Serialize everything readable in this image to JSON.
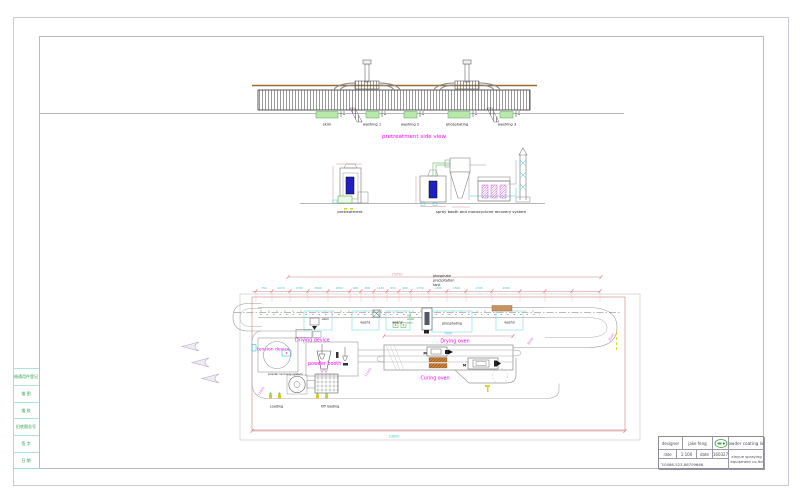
{
  "drawing": {
    "side_view": {
      "title": "pretreatment side view",
      "tank_labels": [
        "skim",
        "washing 1",
        "washing 2",
        "phosphating",
        "washing 3"
      ]
    },
    "elevations": {
      "pretreatment_label": "pretreatment",
      "spray_booth_label": "spray booth and monocyclone recovery system"
    },
    "plan": {
      "note_lines": [
        "phosphate",
        "precipitation",
        "tank"
      ],
      "total_length_dim": "25050",
      "bottom_dim": "23000",
      "oven_dim": "7000",
      "segment_dims": [
        "750",
        "2270",
        "1700",
        "3000",
        "1950",
        "900",
        "800",
        "1445",
        "650",
        "900",
        "1700",
        "1200",
        "1500",
        "1745",
        "2000"
      ],
      "diag_dims": [
        "8000",
        "11000",
        "11000",
        "8000"
      ],
      "labels": {
        "tension_device": "tension device",
        "driving_device": "Driving device",
        "powder_booth": "powder booth",
        "powder_recovery": "powder recovery system",
        "drying_oven": "Drying oven",
        "curing_oven": "Curing oven",
        "loading": "Loading",
        "off_loading": "Off loading",
        "skim": "skim",
        "wash1": "wash1",
        "wash2": "wash2",
        "wash3": "wash3",
        "phosphating": "phosphating",
        "hot_water_lines": [
          "hot",
          "water",
          "tank"
        ],
        "motor": "M"
      }
    }
  },
  "border": {
    "left_strip_rows": [
      "借通用件登记",
      "描 图",
      "描 校",
      "旧底图总号",
      "签 字",
      "日 期"
    ]
  },
  "title_block": {
    "designer_label": "designer",
    "designer_value": "jake feng",
    "rate_label": "rate",
    "rate_value": "1:100",
    "date_label": "date",
    "date_value": "160327",
    "phone": "T:0086-523-86709666",
    "product": "powder coating line",
    "company": [
      "xinyue spraying",
      "equipment co.ltd"
    ]
  },
  "colors": {
    "magenta": "#ff00ff",
    "cyan_dim": "#2ec8d8",
    "red_dim": "#cc7777",
    "green_tank": "#b9e8ab",
    "booth_blue": "#2020c0",
    "beam_brown": "#9a6d2e"
  }
}
